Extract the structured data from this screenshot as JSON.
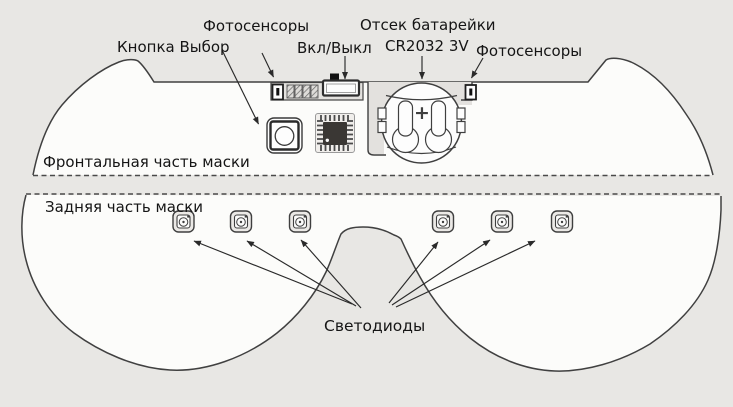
{
  "labels": {
    "photosensors_left": "Фотосенсоры",
    "select_button": "Кнопка Выбор",
    "power_switch": "Вкл/Выкл",
    "battery_compartment": "Отсек батарейки",
    "battery_type": "CR2032 3V",
    "photosensors_right": "Фотосенсоры",
    "front_part": "Фронтальная часть маски",
    "back_part": "Задняя часть маски",
    "leds": "Светодиоды"
  },
  "battery": {
    "polarity": "+"
  },
  "components": {
    "led_count": 6,
    "photosensor_cell_count": 4,
    "chip_present": true,
    "select_button_count": 1
  },
  "colors": {
    "background": "#e8e7e4",
    "mask_fill": "#fcfcfa",
    "outline": "#404040",
    "recess_fill": "#e3e1de",
    "chip_die": "#3a3734"
  }
}
